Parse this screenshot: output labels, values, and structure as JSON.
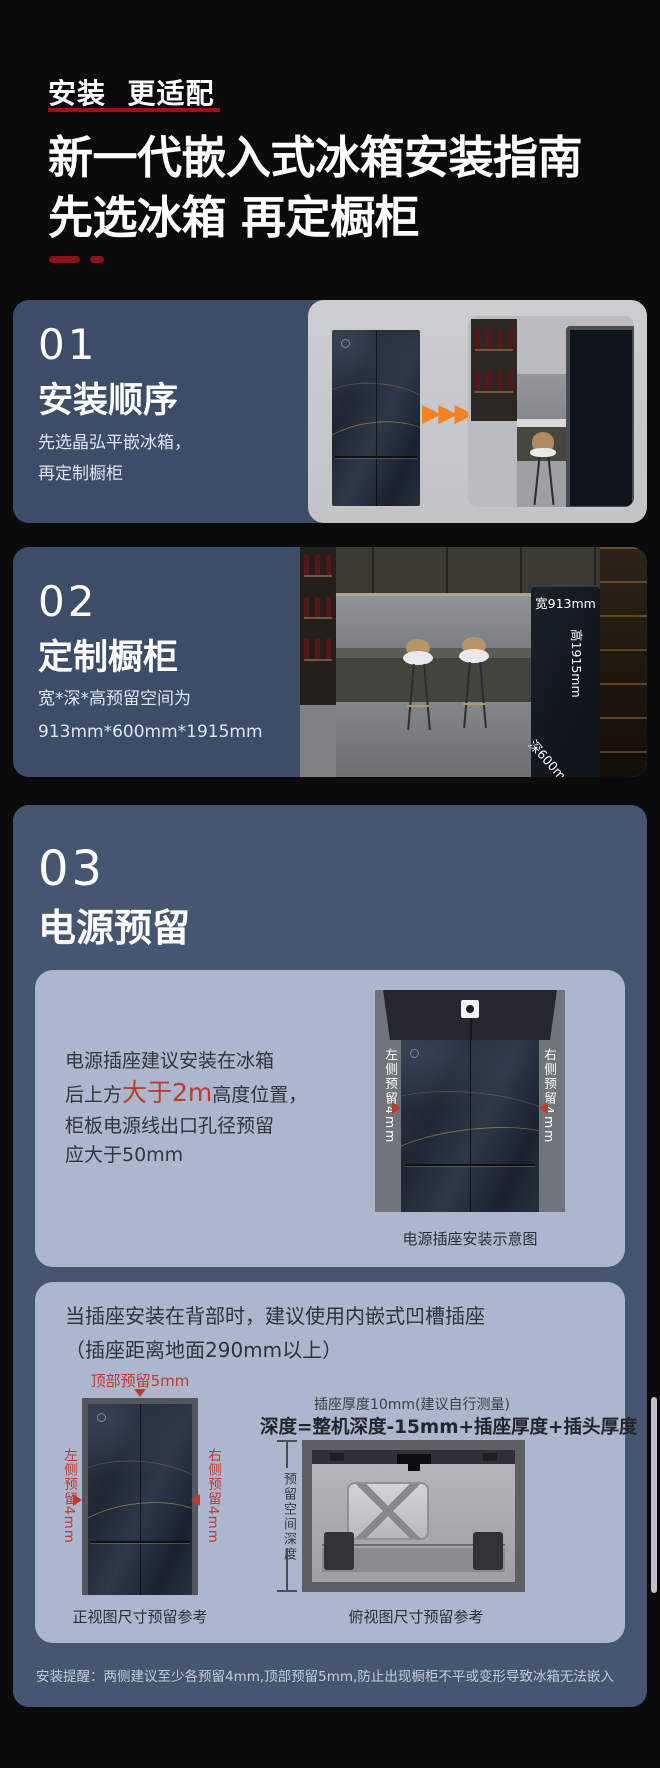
{
  "header": {
    "eyebrow": "安装  更适配",
    "title_line1": "新一代嵌入式冰箱安装指南",
    "title_line2": "先选冰箱 再定橱柜"
  },
  "icons": {
    "play_arrow": "▶"
  },
  "section1": {
    "number": "01",
    "heading": "安装顺序",
    "body_line1": "先选晶弘平嵌冰箱，",
    "body_line2": "再定制橱柜"
  },
  "section2": {
    "number": "02",
    "heading": "定制橱柜",
    "body_line1": "宽*深*高预留空间为",
    "body_line2": "913mm*600mm*1915mm",
    "dim_width": "宽913mm",
    "dim_height": "高1915mm",
    "dim_depth": "深600mm"
  },
  "section3": {
    "number": "03",
    "heading": "电源预留",
    "card1": {
      "line1": "电源插座建议安装在冰箱",
      "line2_prefix": "后上方",
      "line2_red": "大于2m",
      "line2_suffix": "高度位置，",
      "line3": "柜板电源线出口孔径预留",
      "line4": "应大于50mm",
      "label_left": "左侧预留4mm",
      "label_right": "右侧预留4mm",
      "caption": "电源插座安装示意图"
    },
    "card2": {
      "line1": "当插座安装在背部时，建议使用内嵌式凹槽插座",
      "line2": "（插座距离地面290mm以上）",
      "front_view": {
        "label_top": "顶部预留5mm",
        "label_left": "左侧预留4mm",
        "label_right": "右侧预留4mm",
        "caption": "正视图尺寸预留参考"
      },
      "top_view": {
        "note": "插座厚度10mm(建议自行测量)",
        "formula": "深度=整机深度-15mm+插座厚度+插头厚度",
        "depth_label": "预留空间深度",
        "caption": "俯视图尺寸预留参考"
      }
    },
    "footnote": "安装提醒：两侧建议至少各预留4mm,顶部预留5mm,防止出现橱柜不平或变形导致冰箱无法嵌入"
  },
  "colors": {
    "accent_red": "#c13a28",
    "underline_red": "#9e1216",
    "card_blue": "#3c4d68",
    "section_blue": "#455670",
    "subcard_blue": "#acb7cd",
    "arrow_orange": "#f58220"
  }
}
